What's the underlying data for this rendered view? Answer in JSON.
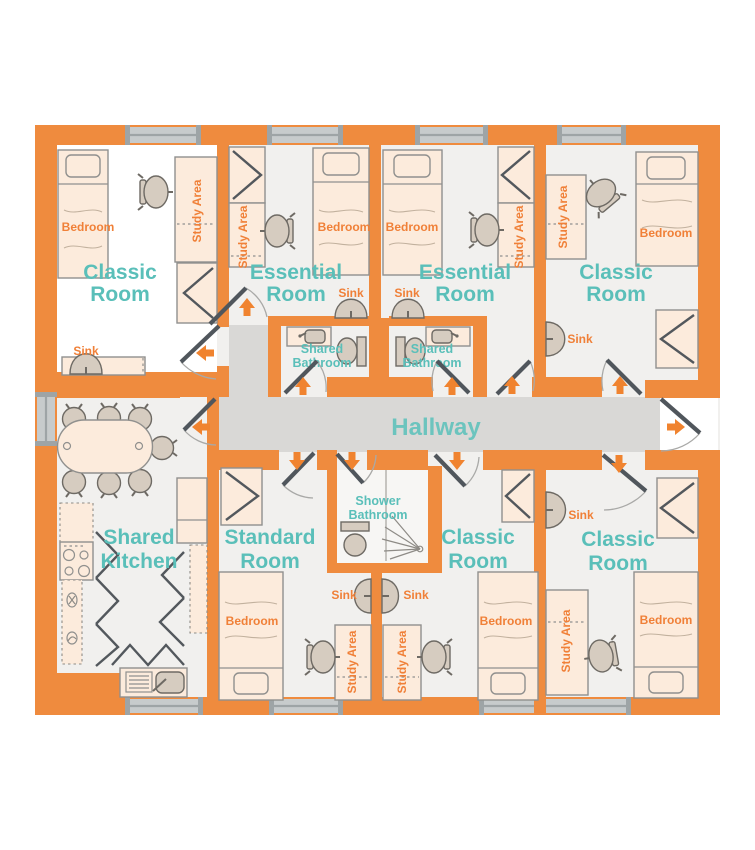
{
  "palette": {
    "wall_orange": "#EF8B3E",
    "accent_orange": "#F08038",
    "arrow_orange": "#F0832F",
    "teal": "#5ABFB9",
    "hallway_gray": "#D9D8D6",
    "floor_gray": "#F1F0EE",
    "floor_white": "#FFFFFF",
    "furniture_fill": "#FCEBDC",
    "fixture_fill": "#D6CCC0",
    "door_leaf": "#50565C",
    "window_gray": "#C7CBCC"
  },
  "hallway": {
    "label": "Hallway"
  },
  "rooms": {
    "classic_top_left": {
      "title_line1": "Classic",
      "title_line2": "Room",
      "bedroom_label": "Bedroom",
      "study_area_label": "Study Area",
      "sink_label": "Sink"
    },
    "essential_left": {
      "title_line1": "Essential",
      "title_line2": "Room",
      "bedroom_label": "Bedroom",
      "study_area_label": "Study Area",
      "sink_label": "Sink"
    },
    "essential_right": {
      "title_line1": "Essential",
      "title_line2": "Room",
      "bedroom_label": "Bedroom",
      "study_area_label": "Study Area",
      "sink_label": "Sink"
    },
    "classic_top_right": {
      "title_line1": "Classic",
      "title_line2": "Room",
      "bedroom_label": "Bedroom",
      "study_area_label": "Study Area",
      "sink_label": "Sink"
    },
    "shared_bathroom_left": {
      "title_line1": "Shared",
      "title_line2": "Bathroom"
    },
    "shared_bathroom_right": {
      "title_line1": "Shared",
      "title_line2": "Bathroom"
    },
    "shared_kitchen": {
      "title_line1": "Shared",
      "title_line2": "Kitchen"
    },
    "standard_room": {
      "title_line1": "Standard",
      "title_line2": "Room",
      "bedroom_label": "Bedroom",
      "study_area_label": "Study Area",
      "sink_label": "Sink"
    },
    "shower_bathroom": {
      "title_line1": "Shower",
      "title_line2": "Bathroom"
    },
    "classic_bottom_middle": {
      "title_line1": "Classic",
      "title_line2": "Room",
      "bedroom_label": "Bedroom",
      "study_area_label": "Study Area",
      "sink_label": "Sink"
    },
    "classic_bottom_right": {
      "title_line1": "Classic",
      "title_line2": "Room",
      "bedroom_label": "Bedroom",
      "study_area_label": "Study Area",
      "sink_label": "Sink"
    }
  }
}
